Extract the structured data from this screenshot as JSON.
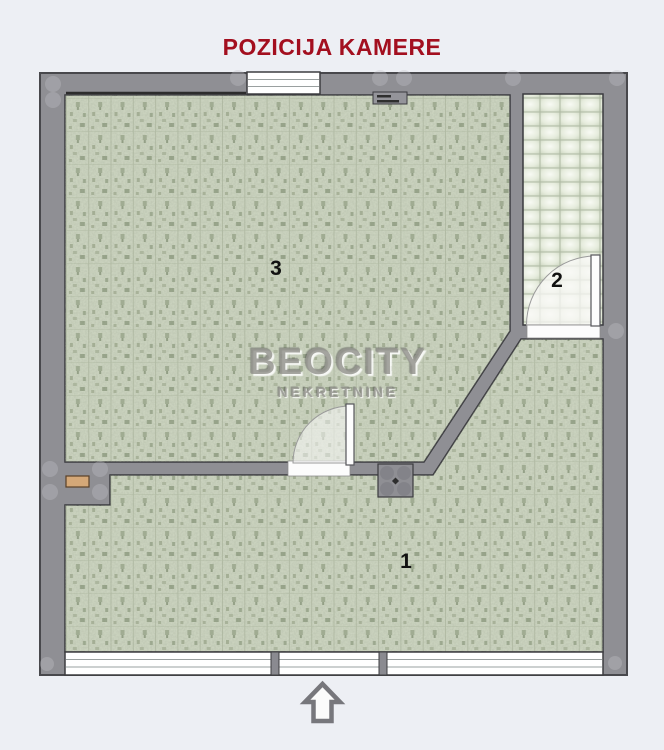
{
  "title": "POZICIJA KAMERE",
  "watermark": {
    "line1": "BEOCITY",
    "line2": "NEKRETNINE"
  },
  "rooms": [
    {
      "number": "1"
    },
    {
      "number": "2"
    },
    {
      "number": "3"
    }
  ],
  "icons": {
    "entrance_arrow": "up-arrow"
  },
  "colors": {
    "title_text": "#a30f1f",
    "wall": "#8f8f94",
    "parquet_floor": "#cfd7c3",
    "tile_floor": "#e6ecdd",
    "background": "#edeff4",
    "niche_shelf": "#d4a878"
  }
}
